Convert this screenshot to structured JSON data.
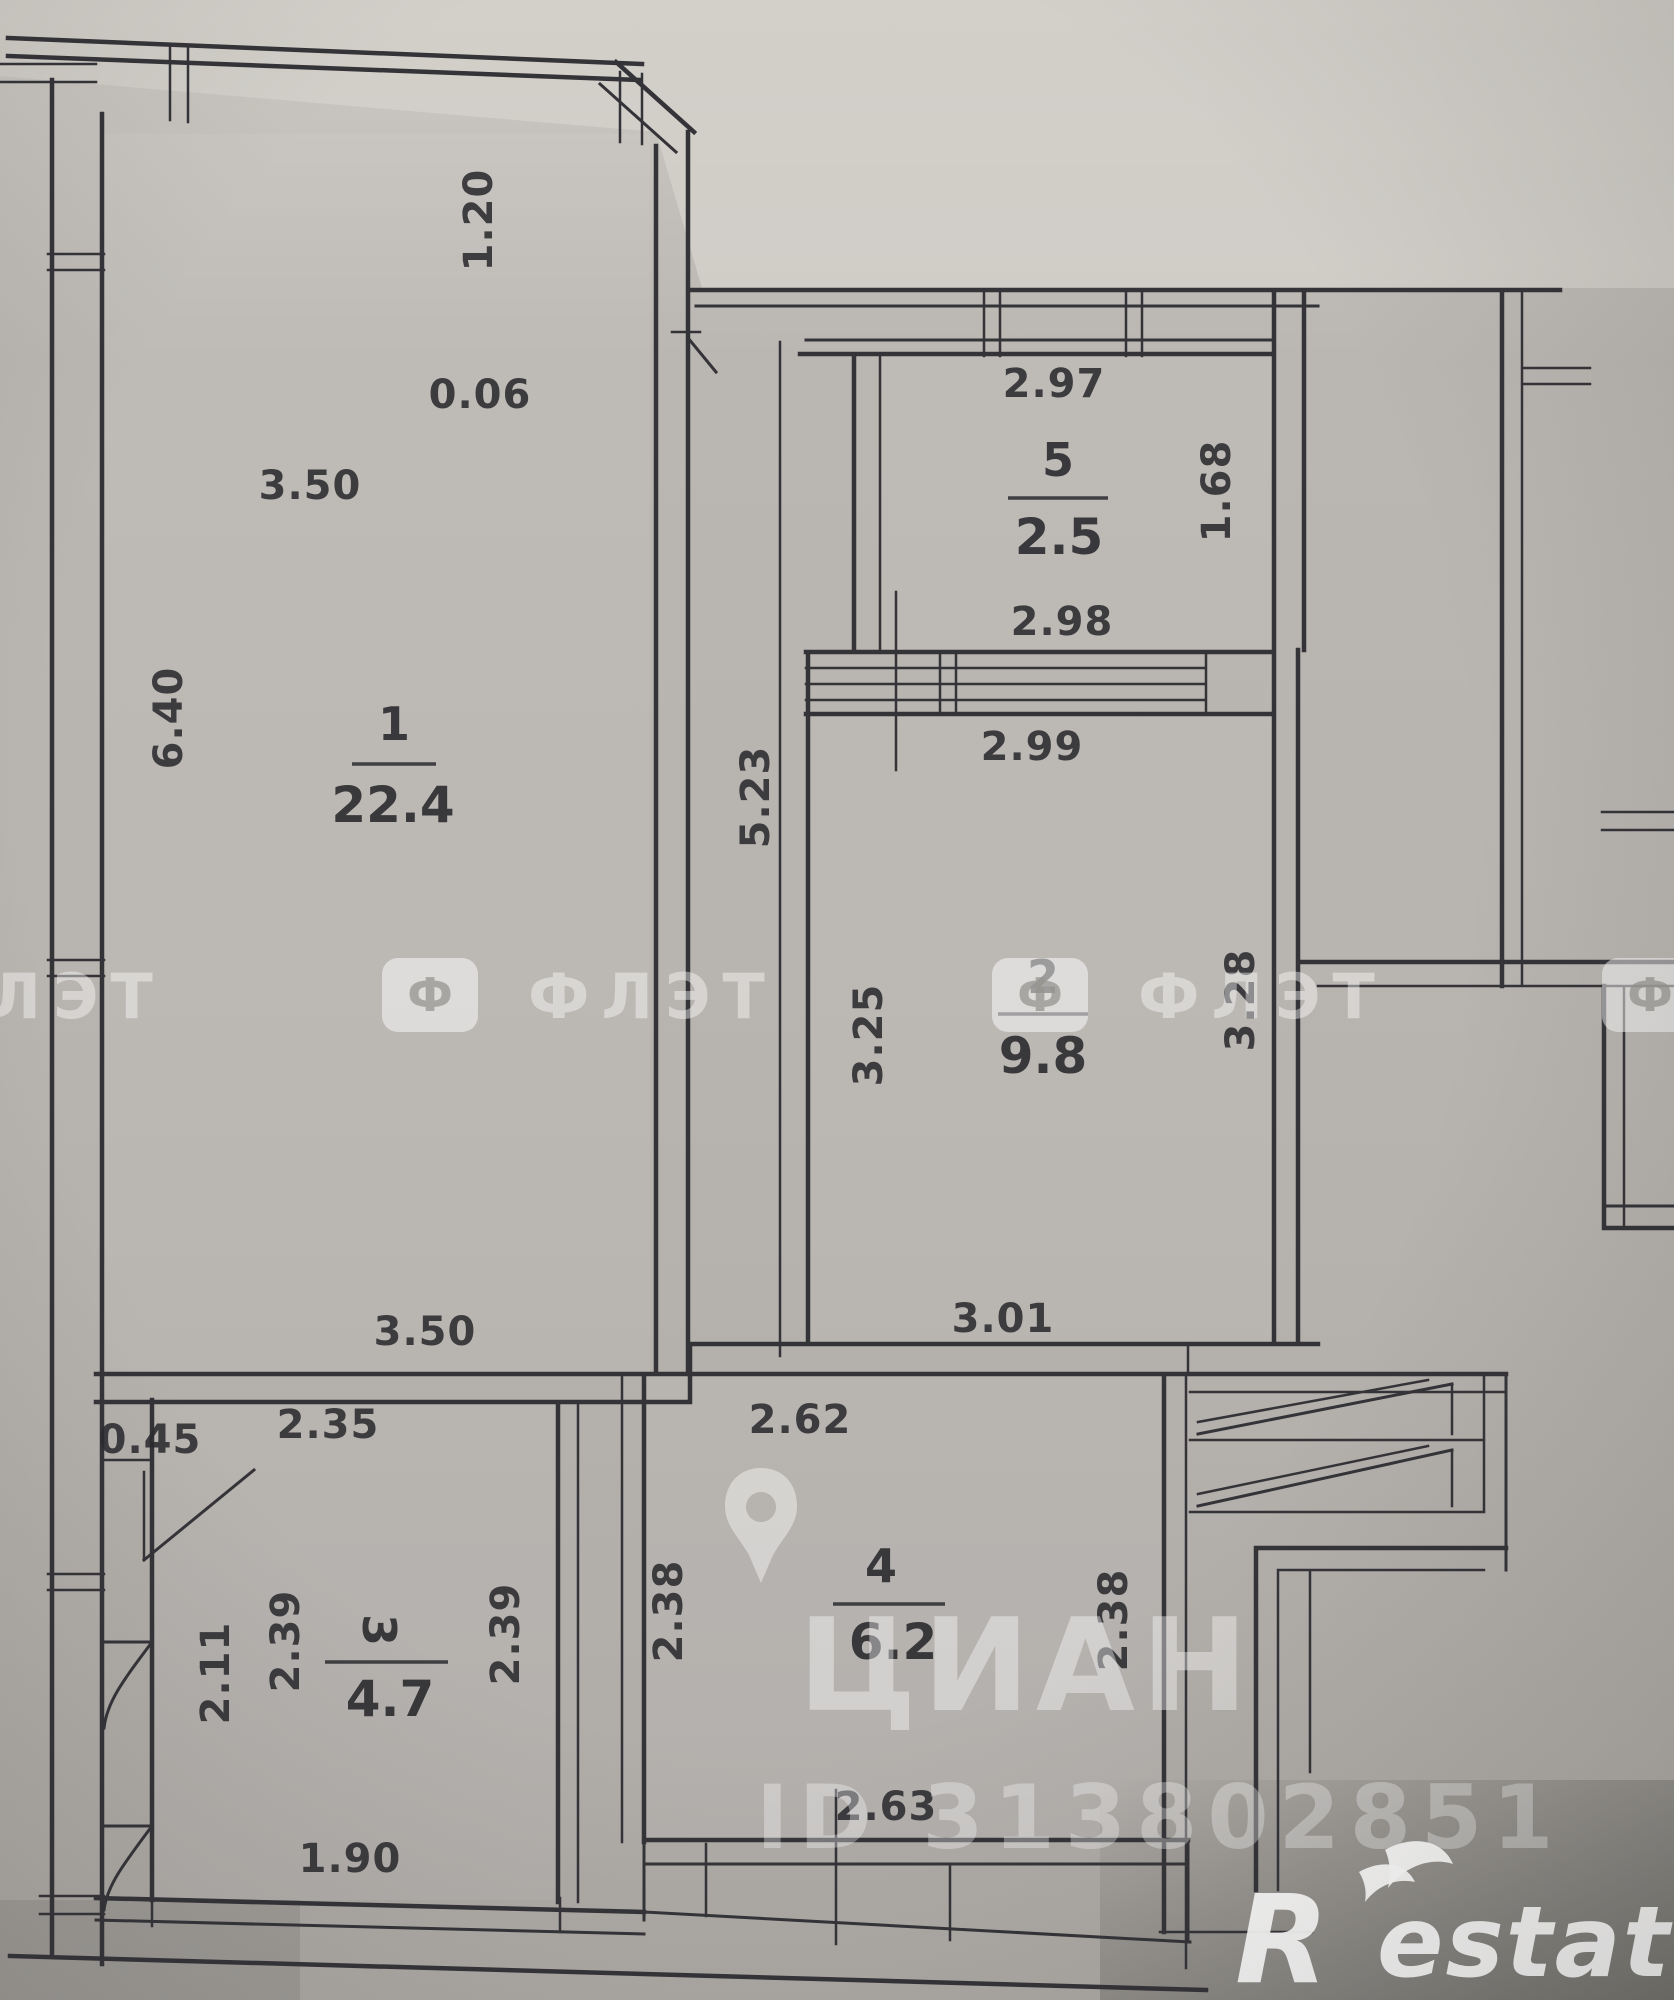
{
  "plan": {
    "rooms": [
      {
        "number": "1",
        "area": "22.4",
        "nx": 394,
        "nby": 740,
        "ax": 393,
        "aby": 822,
        "lx1": 352,
        "lx2": 436,
        "ly": 764
      },
      {
        "number": "2",
        "area": "9.8",
        "nx": 1043,
        "nby": 993,
        "ax": 1043,
        "aby": 1073,
        "lx1": 998,
        "lx2": 1088,
        "ly": 1014
      },
      {
        "number": "3",
        "area": "4.7",
        "nx": 377,
        "nby": 1630,
        "numRot": 90,
        "ax": 390,
        "aby": 1716,
        "lx1": 325,
        "lx2": 448,
        "ly": 1662
      },
      {
        "number": "4",
        "area": "6.2",
        "nx": 881,
        "nby": 1582,
        "ax": 893,
        "aby": 1659,
        "lx1": 833,
        "lx2": 945,
        "ly": 1604
      },
      {
        "number": "5",
        "area": "2.5",
        "nx": 1058,
        "nby": 476,
        "ax": 1059,
        "aby": 554,
        "lx1": 1008,
        "lx2": 1108,
        "ly": 498
      }
    ],
    "dimensions": [
      {
        "value": "3.50",
        "x": 310,
        "y": 485
      },
      {
        "value": "1.20",
        "x": 478,
        "y": 220,
        "rot": -90
      },
      {
        "value": "0.06",
        "x": 480,
        "y": 394
      },
      {
        "value": "6.40",
        "x": 168,
        "y": 718,
        "rot": -90
      },
      {
        "value": "5.23",
        "x": 755,
        "y": 797,
        "rot": -90
      },
      {
        "value": "2.97",
        "x": 1054,
        "y": 383
      },
      {
        "value": "1.68",
        "x": 1216,
        "y": 491,
        "rot": -90
      },
      {
        "value": "2.98",
        "x": 1062,
        "y": 621
      },
      {
        "value": "2.99",
        "x": 1032,
        "y": 746
      },
      {
        "value": "3.25",
        "x": 868,
        "y": 1035,
        "rot": -90
      },
      {
        "value": "3.28",
        "x": 1240,
        "y": 1000,
        "rot": -90
      },
      {
        "value": "3.50",
        "x": 425,
        "y": 1331
      },
      {
        "value": "3.01",
        "x": 1003,
        "y": 1318
      },
      {
        "value": "2.35",
        "x": 328,
        "y": 1424
      },
      {
        "value": "0.45",
        "x": 150,
        "y": 1439
      },
      {
        "value": "2.62",
        "x": 800,
        "y": 1419
      },
      {
        "value": "2.11",
        "x": 215,
        "y": 1673,
        "rot": -90
      },
      {
        "value": "2.39",
        "x": 285,
        "y": 1641,
        "rot": -90
      },
      {
        "value": "2.39",
        "x": 505,
        "y": 1634,
        "rot": -90
      },
      {
        "value": "2.38",
        "x": 668,
        "y": 1611,
        "rot": -90
      },
      {
        "value": "2.38",
        "x": 1113,
        "y": 1620,
        "rot": -90
      },
      {
        "value": "1.90",
        "x": 350,
        "y": 1858
      },
      {
        "value": "2.63",
        "x": 886,
        "y": 1806
      }
    ]
  },
  "watermarks": {
    "flat": {
      "text": "ФЛЭТ",
      "icon_letter": "Ф",
      "row_y": 958,
      "positions": [
        -230,
        382,
        992,
        1602
      ]
    },
    "cian": {
      "text": "ЦИАН"
    },
    "listing_id": "ID 313802851",
    "restate": {
      "r": "R",
      "rest": "estate"
    }
  }
}
